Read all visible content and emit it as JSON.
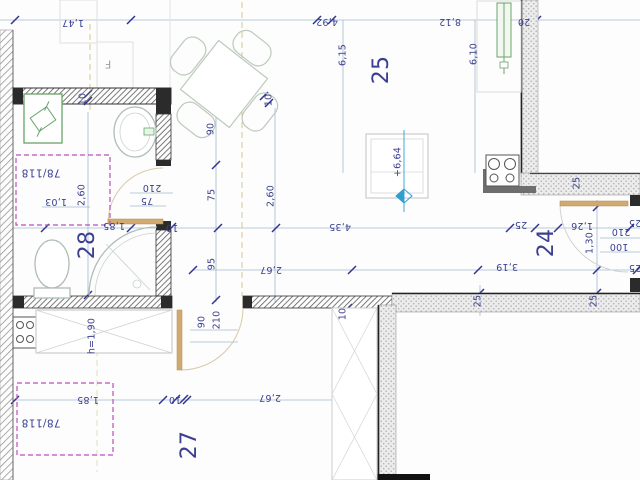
{
  "drawing_type": "architectural floor plan",
  "colors": {
    "label_navy": "#3a3f8f",
    "tick_navy": "#2f3490",
    "dim_line": "#9fb9cc",
    "magenta": "#bb4fbb",
    "olive": "#c9bc72",
    "door_tan": "#d2a96e",
    "door_arc": "#d9c9a8",
    "fixture_green": "#69a569",
    "fixture_gray": "#b0bdb6",
    "furniture_gray": "#bccabb",
    "wall_dark": "#2b2b2b",
    "marker_teal": "#2f9fd0"
  },
  "rooms": [
    {
      "number": "25"
    },
    {
      "number": "28"
    },
    {
      "number": "24"
    },
    {
      "number": "27"
    }
  ],
  "labels": [
    {
      "text": "1,47",
      "x": 73,
      "y": 22,
      "rot": 180,
      "kind": "dim",
      "name": "dim-1-47"
    },
    {
      "text": "4,92",
      "x": 327,
      "y": 21,
      "rot": 180,
      "kind": "dim",
      "name": "dim-4-92"
    },
    {
      "text": "8,12",
      "x": 450,
      "y": 21,
      "rot": 180,
      "kind": "dim",
      "name": "dim-8-12"
    },
    {
      "text": "20",
      "x": 524,
      "y": 21,
      "rot": 180,
      "kind": "dim",
      "name": "dim-20-wall"
    },
    {
      "text": "6,15",
      "x": 343,
      "y": 55,
      "rot": -90,
      "kind": "dim",
      "name": "dim-6-15"
    },
    {
      "text": "6,10",
      "x": 474,
      "y": 54,
      "rot": -90,
      "kind": "dim",
      "name": "dim-6-10"
    },
    {
      "text": "25",
      "x": 382,
      "y": 70,
      "rot": -90,
      "kind": "room",
      "name": "room-25"
    },
    {
      "text": "F",
      "x": 108,
      "y": 64,
      "rot": 180,
      "kind": "flabel",
      "name": "label-f"
    },
    {
      "text": "10",
      "x": 83,
      "y": 99,
      "rot": -90,
      "kind": "dim",
      "name": "dim-10-bath-top"
    },
    {
      "text": "90",
      "x": 211,
      "y": 129,
      "rot": -90,
      "kind": "dim",
      "name": "dim-90-table"
    },
    {
      "text": "10",
      "x": 269,
      "y": 100,
      "rot": -90,
      "kind": "dim",
      "name": "dim-10-table"
    },
    {
      "text": "78/118",
      "x": 41,
      "y": 172,
      "rot": 180,
      "kind": "ref",
      "name": "ref-78-118-upper"
    },
    {
      "text": "1,03",
      "x": 56,
      "y": 201,
      "rot": 180,
      "kind": "dim",
      "name": "dim-1-03"
    },
    {
      "text": "2,60",
      "x": 82,
      "y": 195,
      "rot": -90,
      "kind": "dim",
      "name": "dim-2-60-bath"
    },
    {
      "text": "210",
      "x": 152,
      "y": 187,
      "rot": 180,
      "kind": "dim",
      "name": "dim-210-bath-door"
    },
    {
      "text": "75",
      "x": 147,
      "y": 200,
      "rot": 180,
      "kind": "dim",
      "name": "dim-75-bath-door"
    },
    {
      "text": "1,85",
      "x": 114,
      "y": 225,
      "rot": 180,
      "kind": "dim",
      "name": "dim-1-85-bath"
    },
    {
      "text": "10",
      "x": 172,
      "y": 227,
      "rot": 180,
      "kind": "dim",
      "name": "dim-10-bath-wall"
    },
    {
      "text": "28",
      "x": 88,
      "y": 245,
      "rot": -90,
      "kind": "room",
      "name": "room-28"
    },
    {
      "text": "75",
      "x": 212,
      "y": 195,
      "rot": -90,
      "kind": "dim",
      "name": "dim-75-mid"
    },
    {
      "text": "2,60",
      "x": 271,
      "y": 196,
      "rot": -90,
      "kind": "dim",
      "name": "dim-2-60-living"
    },
    {
      "text": "4,35",
      "x": 340,
      "y": 226,
      "rot": 180,
      "kind": "dim",
      "name": "dim-4-35"
    },
    {
      "text": "95",
      "x": 212,
      "y": 264,
      "rot": -90,
      "kind": "dim",
      "name": "dim-95-mid"
    },
    {
      "text": "2,67",
      "x": 271,
      "y": 269,
      "rot": 180,
      "kind": "dim",
      "name": "dim-2-67-mid"
    },
    {
      "text": "+6,64",
      "x": 398,
      "y": 162,
      "rot": -90,
      "kind": "note",
      "name": "level-6-64"
    },
    {
      "text": "25",
      "x": 521,
      "y": 224,
      "rot": 180,
      "kind": "dim",
      "name": "dim-25-r24-top"
    },
    {
      "text": "24",
      "x": 547,
      "y": 243,
      "rot": -90,
      "kind": "room",
      "name": "room-24"
    },
    {
      "text": "1,26",
      "x": 582,
      "y": 225,
      "rot": 180,
      "kind": "dim",
      "name": "dim-1-26"
    },
    {
      "text": "1,30",
      "x": 590,
      "y": 243,
      "rot": -90,
      "kind": "dim",
      "name": "dim-1-30"
    },
    {
      "text": "210",
      "x": 621,
      "y": 231,
      "rot": 180,
      "kind": "dim",
      "name": "dim-210-r24-door"
    },
    {
      "text": "100",
      "x": 619,
      "y": 246,
      "rot": 180,
      "kind": "dim",
      "name": "dim-100-r24-door"
    },
    {
      "text": "25",
      "x": 577,
      "y": 183,
      "rot": -90,
      "kind": "dim",
      "name": "dim-25-right-wall"
    },
    {
      "text": "25",
      "x": 635,
      "y": 222,
      "rot": 180,
      "kind": "dim",
      "name": "dim-25-right-edge-1"
    },
    {
      "text": "25",
      "x": 635,
      "y": 267,
      "rot": 180,
      "kind": "dim",
      "name": "dim-25-right-edge-2"
    },
    {
      "text": "3,19",
      "x": 507,
      "y": 266,
      "rot": 180,
      "kind": "dim",
      "name": "dim-3-19"
    },
    {
      "text": "25",
      "x": 478,
      "y": 301,
      "rot": -90,
      "kind": "dim",
      "name": "dim-25-bottom-1"
    },
    {
      "text": "25",
      "x": 594,
      "y": 301,
      "rot": -90,
      "kind": "dim",
      "name": "dim-25-bottom-2"
    },
    {
      "text": "h=1,90",
      "x": 92,
      "y": 336,
      "rot": -90,
      "kind": "note",
      "name": "note-h-190"
    },
    {
      "text": "90",
      "x": 202,
      "y": 322,
      "rot": -90,
      "kind": "dim",
      "name": "dim-90-r27-door"
    },
    {
      "text": "210",
      "x": 217,
      "y": 320,
      "rot": -90,
      "kind": "dim",
      "name": "dim-210-r27-door"
    },
    {
      "text": "10",
      "x": 343,
      "y": 314,
      "rot": -90,
      "kind": "dim",
      "name": "dim-10-mid-wall"
    },
    {
      "text": "2,67",
      "x": 270,
      "y": 397,
      "rot": 180,
      "kind": "dim",
      "name": "dim-2-67-bottom"
    },
    {
      "text": "1,85",
      "x": 88,
      "y": 399,
      "rot": 180,
      "kind": "dim",
      "name": "dim-1-85-bottom"
    },
    {
      "text": "10",
      "x": 175,
      "y": 399,
      "rot": 180,
      "kind": "dim",
      "name": "dim-10-bottom"
    },
    {
      "text": "78/118",
      "x": 41,
      "y": 422,
      "rot": 180,
      "kind": "ref",
      "name": "ref-78-118-lower"
    },
    {
      "text": "27",
      "x": 190,
      "y": 445,
      "rot": -90,
      "kind": "room",
      "name": "room-27"
    }
  ]
}
